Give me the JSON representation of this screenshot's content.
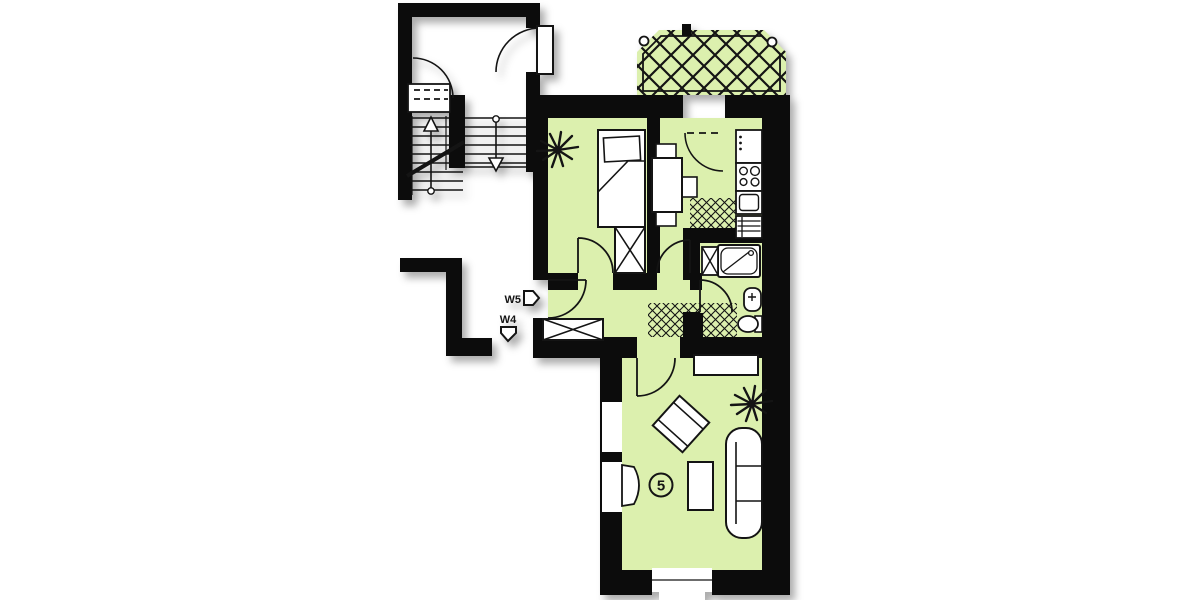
{
  "plan": {
    "type": "apartment-floor-plan",
    "unit_number": "5",
    "entrance_labels": [
      {
        "id": "W5",
        "arrow_direction": "right"
      },
      {
        "id": "W4",
        "arrow_direction": "down"
      }
    ],
    "stair_arrows": {
      "left_flight": "up",
      "right_flight": "down"
    }
  },
  "colors": {
    "paper": "#ffffff",
    "wall": "#0c0c0c",
    "line": "#141414",
    "room_fill": "#dcf0ae",
    "shadow": "rgba(0,0,0,0.32)"
  }
}
